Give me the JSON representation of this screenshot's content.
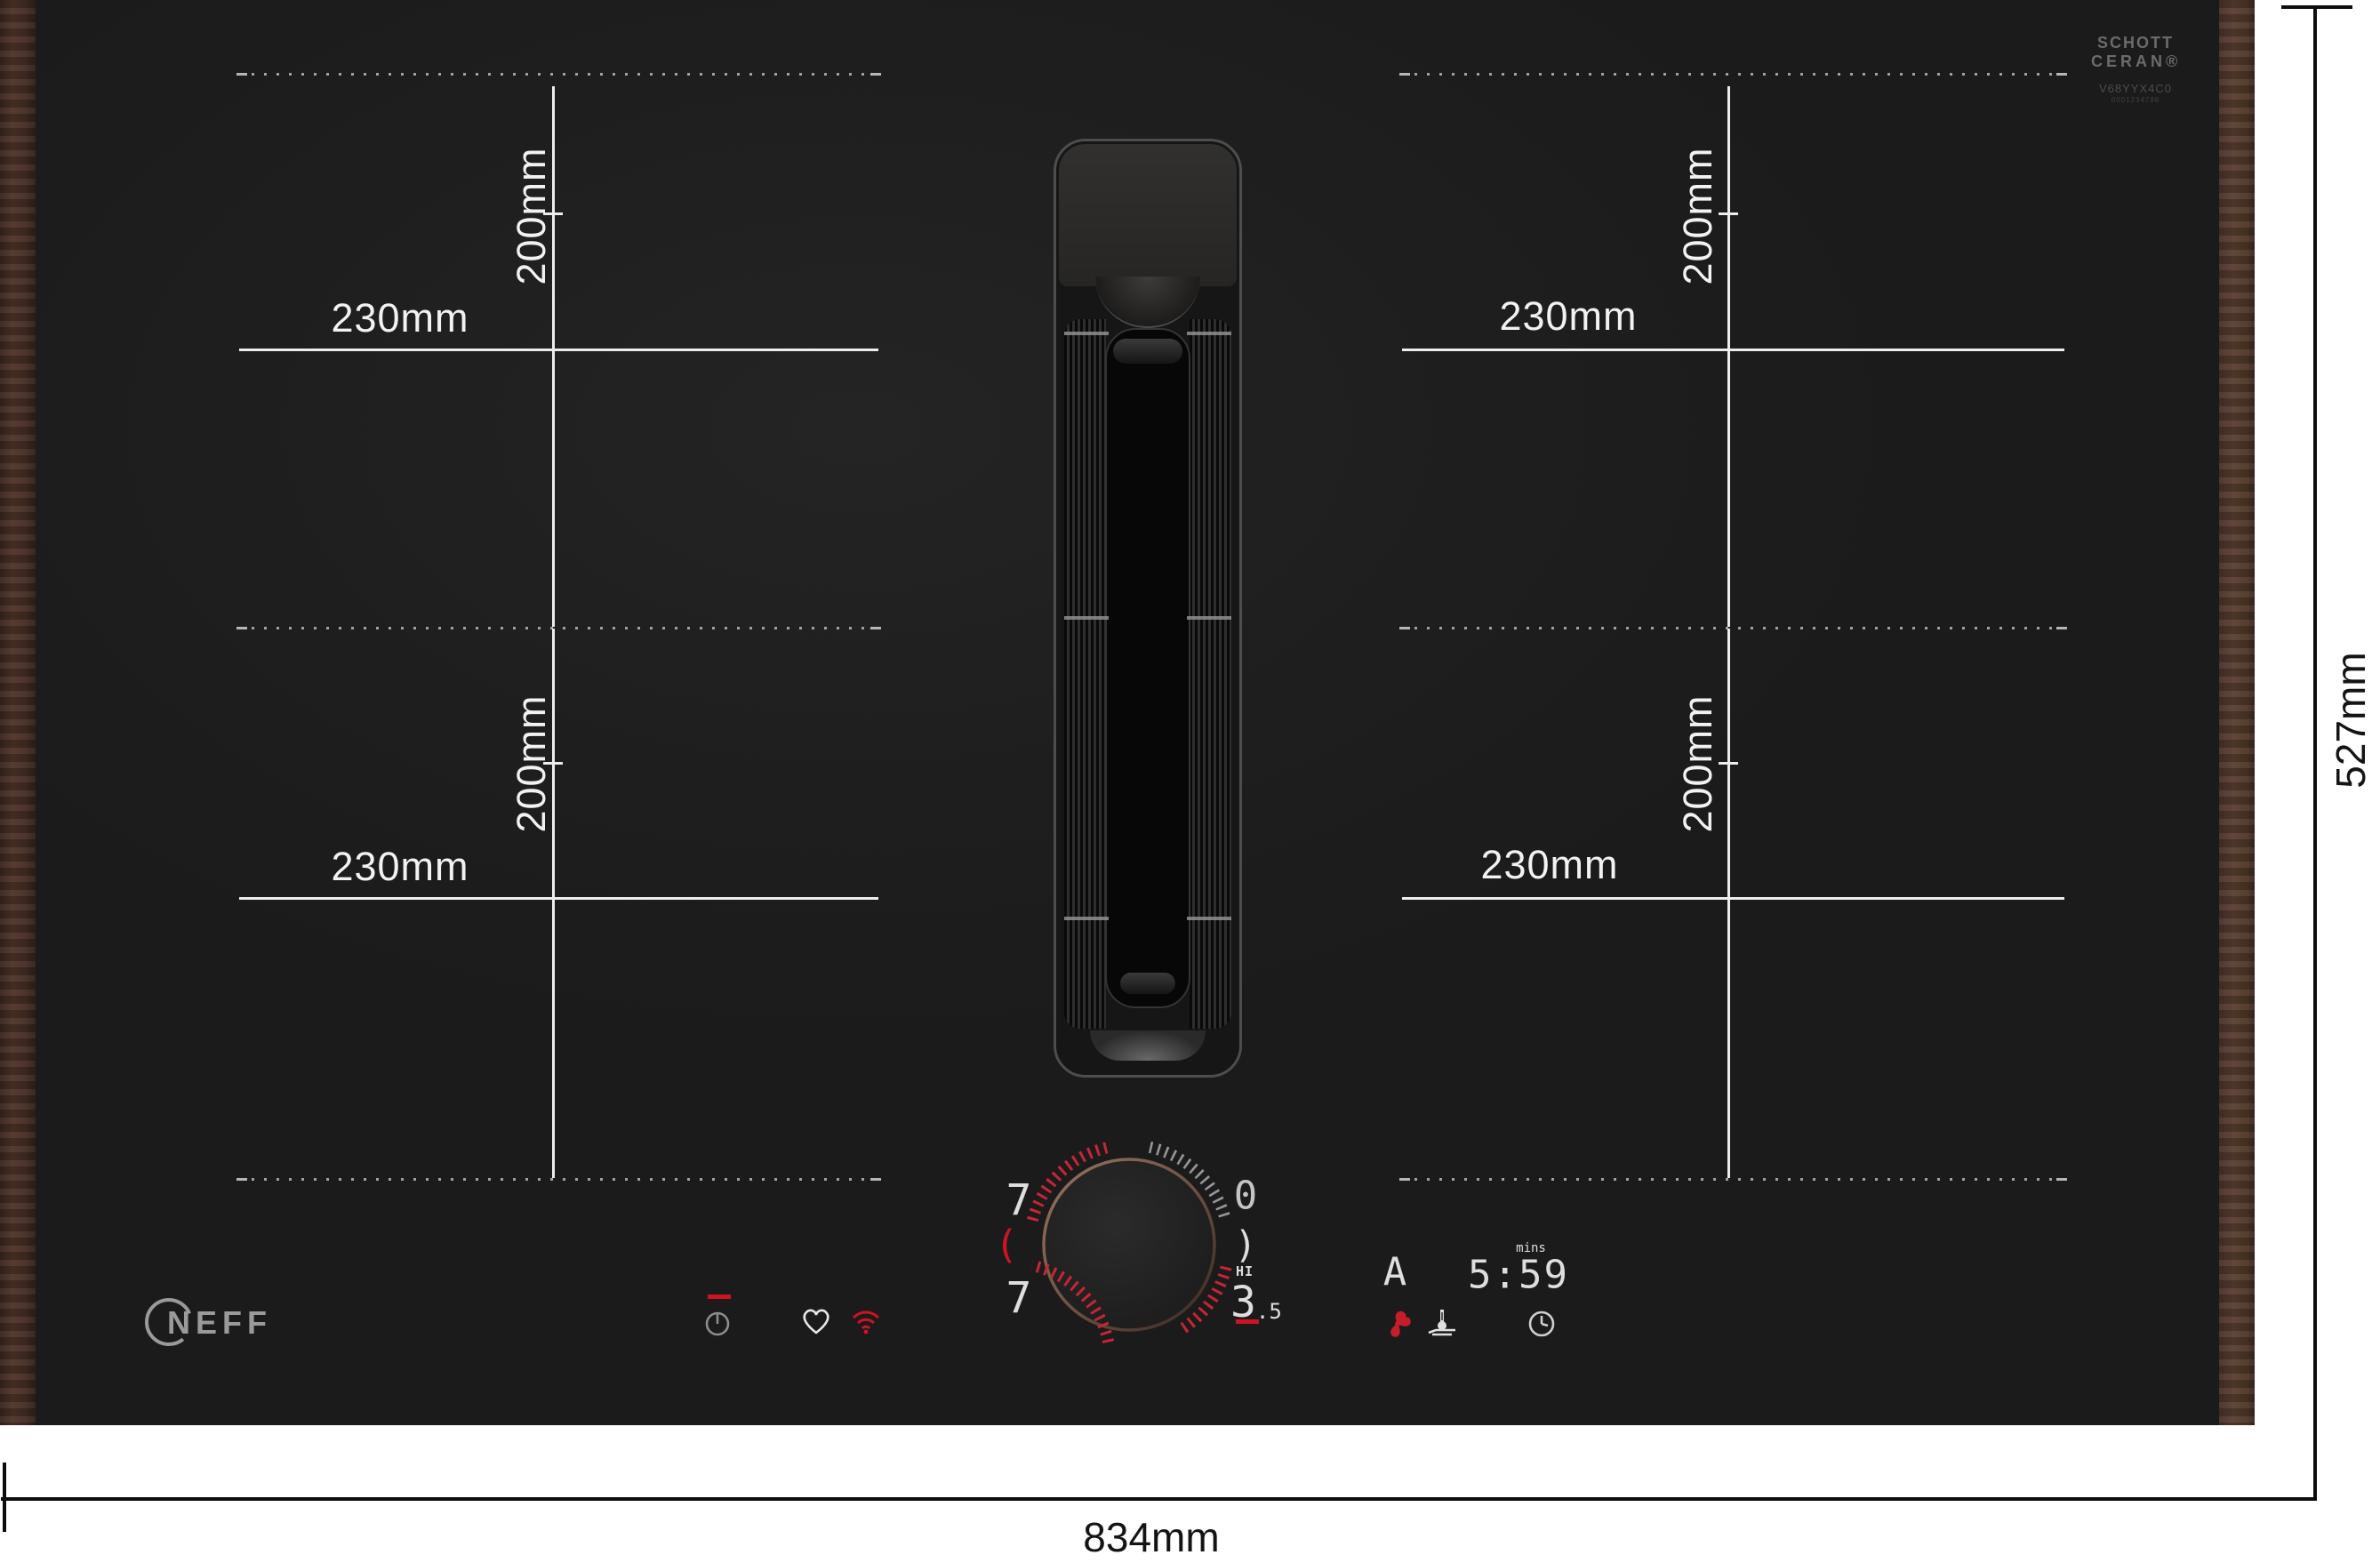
{
  "measure": {
    "zone_width": "230mm",
    "zone_height": "200mm"
  },
  "overall": {
    "width": "834mm",
    "height": "527mm"
  },
  "branding": {
    "maker": "NEFF",
    "glass": {
      "line1": "SCHOTT",
      "line2": "CERAN®",
      "code": "V68YYX4C0",
      "code2": "0001234786"
    }
  },
  "knob": {
    "top_left_digit": "7",
    "bottom_left_digit": "7",
    "top_right_digit": "0",
    "left_bracket": "(",
    "right_bracket": ")",
    "hi_label": "HI",
    "value": "3",
    "value_decimal": ".5"
  },
  "display": {
    "auto_indicator": "A",
    "timer_value": "5:59",
    "timer_unit": "mins"
  },
  "icons": {
    "power": "power-icon",
    "favorite": "heart-icon",
    "wifi": "wifi-icon",
    "fan": "fan-icon",
    "cooking_sensor": "pan-thermometer-icon",
    "timer": "clock-icon"
  },
  "colors": {
    "surface": "#1e1e1e",
    "accent_red": "#cf1322",
    "wood": "#4f362b",
    "guide_line": "#ededed"
  }
}
